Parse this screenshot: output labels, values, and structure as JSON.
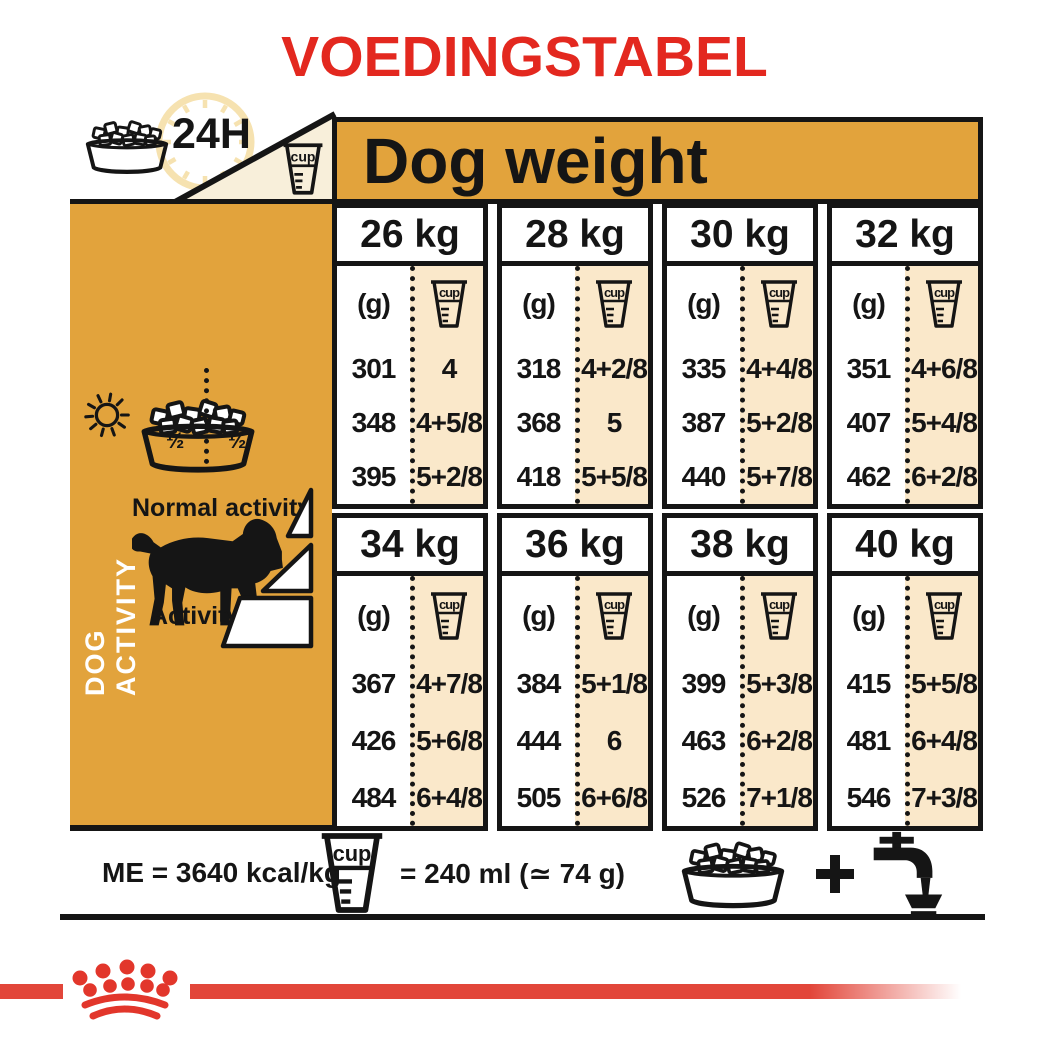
{
  "title": "VOEDINGSTABEL",
  "table": {
    "header": "Dog weight",
    "unit_label": "(g)",
    "cup_label": "cup",
    "groups": [
      {
        "columns": [
          {
            "weight": "26 kg",
            "rows": [
              {
                "g": "301",
                "cup": "4"
              },
              {
                "g": "348",
                "cup": "4+5/8"
              },
              {
                "g": "395",
                "cup": "5+2/8"
              }
            ]
          },
          {
            "weight": "28 kg",
            "rows": [
              {
                "g": "318",
                "cup": "4+2/8"
              },
              {
                "g": "368",
                "cup": "5"
              },
              {
                "g": "418",
                "cup": "5+5/8"
              }
            ]
          },
          {
            "weight": "30 kg",
            "rows": [
              {
                "g": "335",
                "cup": "4+4/8"
              },
              {
                "g": "387",
                "cup": "5+2/8"
              },
              {
                "g": "440",
                "cup": "5+7/8"
              }
            ]
          },
          {
            "weight": "32 kg",
            "rows": [
              {
                "g": "351",
                "cup": "4+6/8"
              },
              {
                "g": "407",
                "cup": "5+4/8"
              },
              {
                "g": "462",
                "cup": "6+2/8"
              }
            ]
          }
        ]
      },
      {
        "columns": [
          {
            "weight": "34 kg",
            "rows": [
              {
                "g": "367",
                "cup": "4+7/8"
              },
              {
                "g": "426",
                "cup": "5+6/8"
              },
              {
                "g": "484",
                "cup": "6+4/8"
              }
            ]
          },
          {
            "weight": "36 kg",
            "rows": [
              {
                "g": "384",
                "cup": "5+1/8"
              },
              {
                "g": "444",
                "cup": "6"
              },
              {
                "g": "505",
                "cup": "6+6/8"
              }
            ]
          },
          {
            "weight": "38 kg",
            "rows": [
              {
                "g": "399",
                "cup": "5+3/8"
              },
              {
                "g": "463",
                "cup": "6+2/8"
              },
              {
                "g": "526",
                "cup": "7+1/8"
              }
            ]
          },
          {
            "weight": "40 kg",
            "rows": [
              {
                "g": "415",
                "cup": "5+5/8"
              },
              {
                "g": "481",
                "cup": "6+4/8"
              },
              {
                "g": "546",
                "cup": "7+3/8"
              }
            ]
          }
        ]
      }
    ]
  },
  "sidebar": {
    "label_24h": "24H",
    "half_left": "½",
    "half_right": "½",
    "dog_activity_label": "DOG ACTIVITY",
    "normal_activity_label": "Normal activity",
    "activity_label": "Activity"
  },
  "footer": {
    "me_label": "ME = 3640 kcal/kg",
    "cup_equiv": "= 240 ml (≃ 74 g)"
  },
  "colors": {
    "red": "#E3281F",
    "orange": "#E2A33C",
    "beige": "#FAE8CA",
    "cream": "#F8EFDA",
    "black": "#151515"
  },
  "chart_data": {
    "type": "table",
    "title": "VOEDINGSTABEL",
    "column_group_header": "Dog weight",
    "units": [
      "(g)",
      "cup"
    ],
    "columns": [
      "26 kg",
      "28 kg",
      "30 kg",
      "32 kg",
      "34 kg",
      "36 kg",
      "38 kg",
      "40 kg"
    ],
    "rows": [
      {
        "weight": "26 kg",
        "grams": [
          301,
          348,
          395
        ],
        "cups": [
          "4",
          "4+5/8",
          "5+2/8"
        ]
      },
      {
        "weight": "28 kg",
        "grams": [
          318,
          368,
          418
        ],
        "cups": [
          "4+2/8",
          "5",
          "5+5/8"
        ]
      },
      {
        "weight": "30 kg",
        "grams": [
          335,
          387,
          440
        ],
        "cups": [
          "4+4/8",
          "5+2/8",
          "5+7/8"
        ]
      },
      {
        "weight": "32 kg",
        "grams": [
          351,
          407,
          462
        ],
        "cups": [
          "4+6/8",
          "5+4/8",
          "6+2/8"
        ]
      },
      {
        "weight": "34 kg",
        "grams": [
          367,
          426,
          484
        ],
        "cups": [
          "4+7/8",
          "5+6/8",
          "6+4/8"
        ]
      },
      {
        "weight": "36 kg",
        "grams": [
          384,
          444,
          505
        ],
        "cups": [
          "5+1/8",
          "6",
          "6+6/8"
        ]
      },
      {
        "weight": "38 kg",
        "grams": [
          399,
          463,
          526
        ],
        "cups": [
          "5+3/8",
          "6+2/8",
          "7+1/8"
        ]
      },
      {
        "weight": "40 kg",
        "grams": [
          415,
          481,
          546
        ],
        "cups": [
          "5+5/8",
          "6+4/8",
          "7+3/8"
        ]
      }
    ],
    "row_meaning": [
      "normal activity lower",
      "normal activity",
      "high activity"
    ],
    "notes": {
      "me_kcal_per_kg": 3640,
      "cup_measure_ml": 240,
      "cup_measure_g": 74,
      "me_label": "ME = 3640 kcal/kg",
      "cup_equivalence": "= 240 ml (≃ 74 g)"
    }
  }
}
